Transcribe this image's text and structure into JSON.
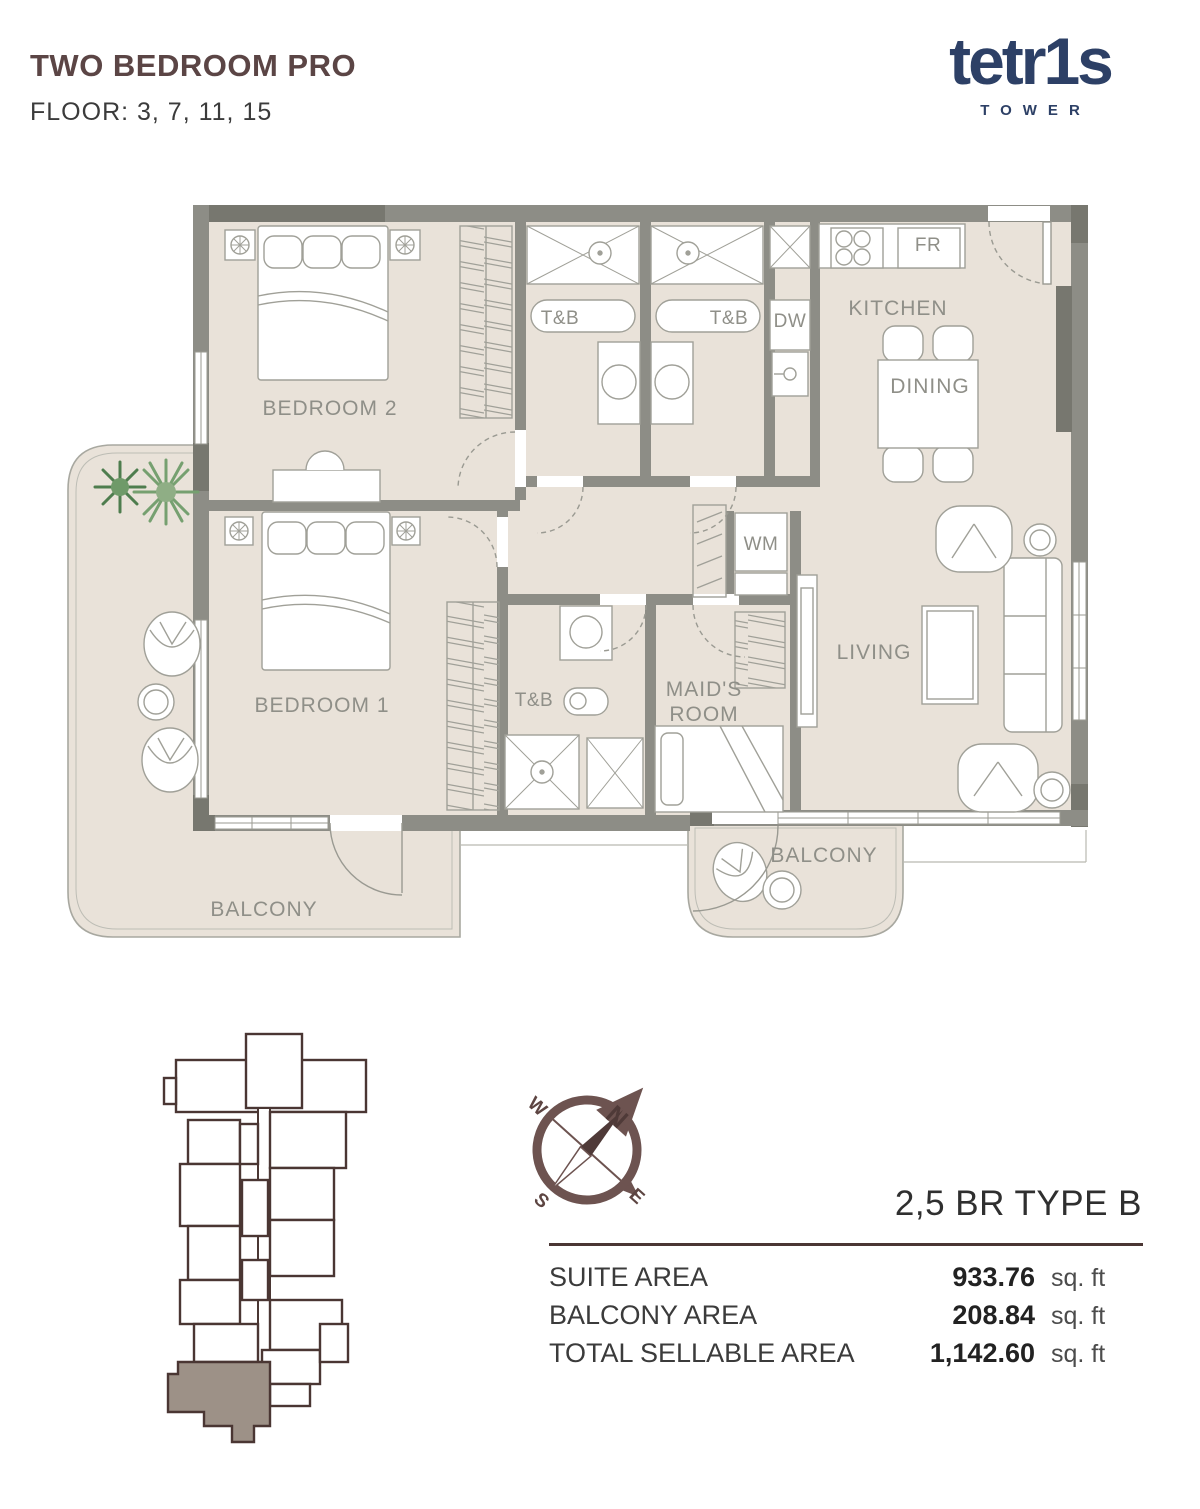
{
  "header": {
    "title": "TWO BEDROOM PRO",
    "floors": "FLOOR: 3, 7, 11, 15"
  },
  "brand": {
    "logo": "tetr1s",
    "sub": "TOWER",
    "color": "#2d4066"
  },
  "plan": {
    "labels": {
      "bedroom2": "BEDROOM 2",
      "bedroom1": "BEDROOM 1",
      "tb_top_left": "T&B",
      "tb_top_right": "T&B",
      "tb_lower": "T&B",
      "dw": "DW",
      "fr": "FR",
      "wm": "WM",
      "kitchen": "KITCHEN",
      "dining": "DINING",
      "living": "LIVING",
      "maids_room": "MAID'S ROOM",
      "balcony_main": "BALCONY",
      "balcony_small": "BALCONY"
    },
    "colors": {
      "floor": "#e9e2d9",
      "wall": "#8d8d86",
      "wall_dark": "#77776f",
      "furniture_line": "#a0a098",
      "label_text": "#8f8f88"
    }
  },
  "compass": {
    "n": "N",
    "e": "E",
    "s": "S",
    "w": "W"
  },
  "key_plan": {
    "highlight_color": "#9d9187",
    "outline_color": "#4a3633"
  },
  "unit_info": {
    "heading": "2,5 BR TYPE B",
    "rows": [
      {
        "label": "SUITE AREA",
        "value": "933.76",
        "unit": "sq. ft"
      },
      {
        "label": "BALCONY AREA",
        "value": "208.84",
        "unit": "sq. ft"
      },
      {
        "label": "TOTAL SELLABLE AREA",
        "value": "1,142.60",
        "unit": "sq. ft"
      }
    ]
  }
}
